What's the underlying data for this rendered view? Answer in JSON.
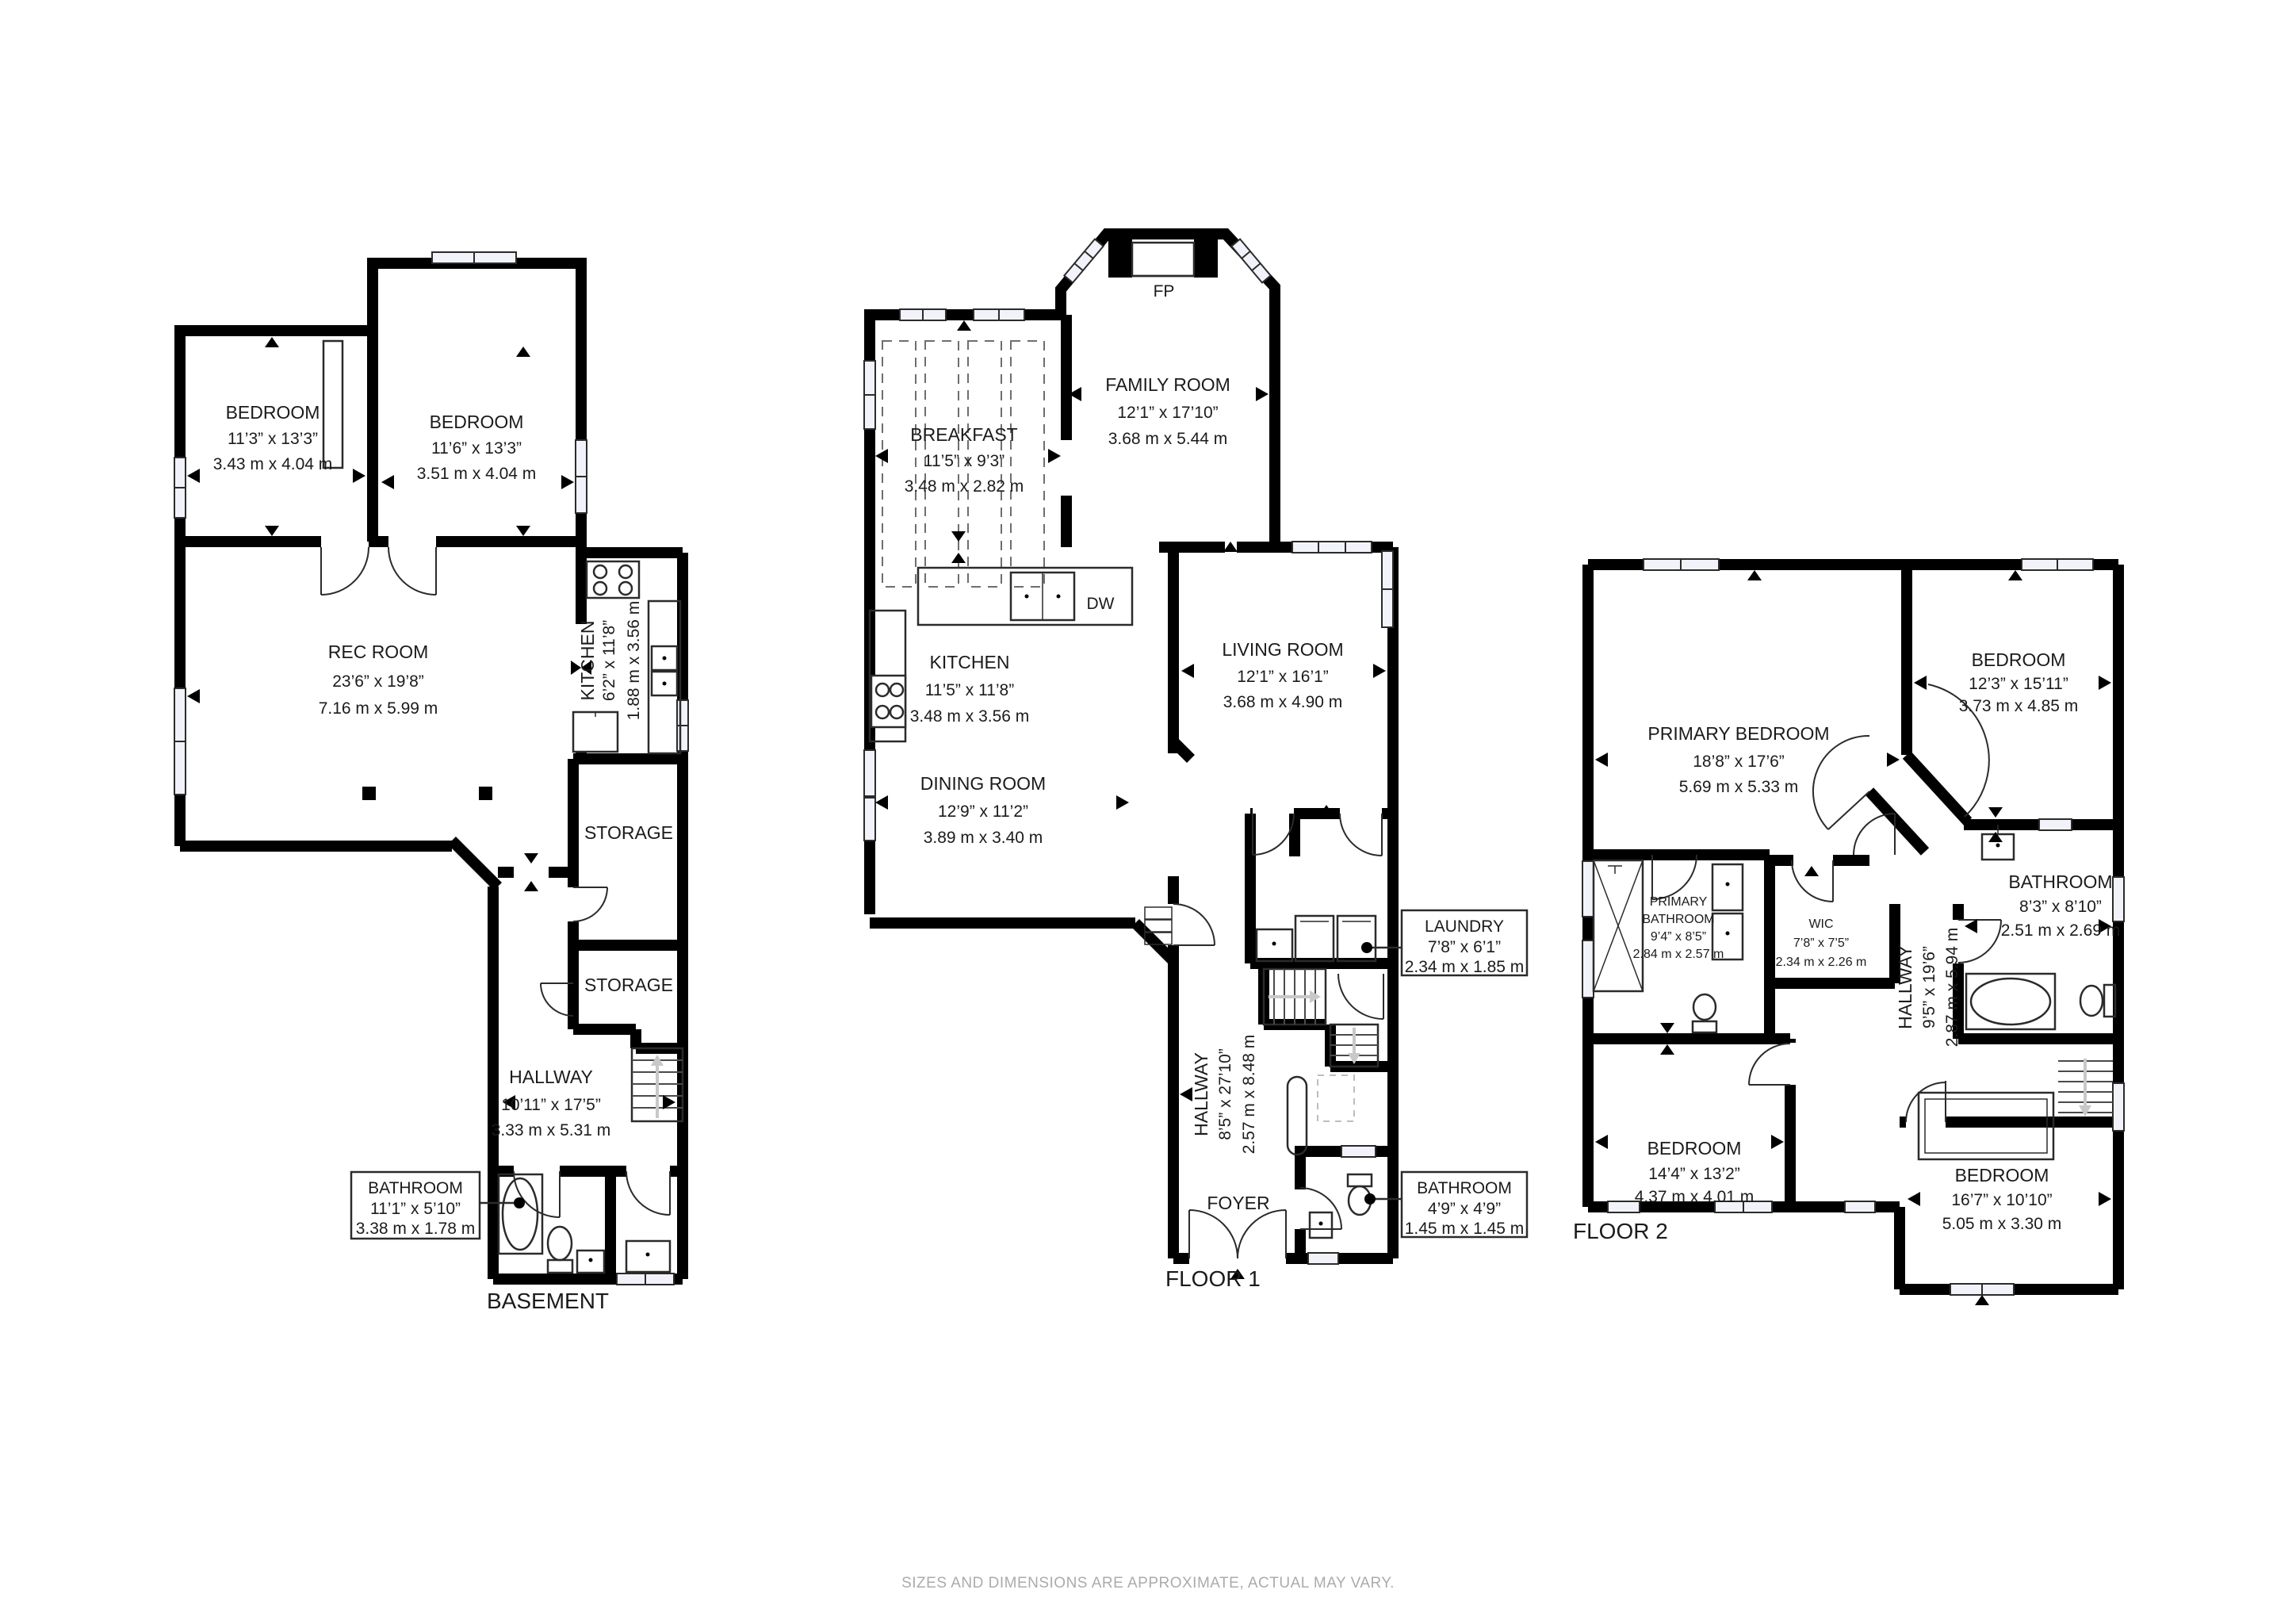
{
  "colors": {
    "wall": "#000000",
    "text": "#1b1b1b",
    "window_fill": "#f2f3fa",
    "muted_footer": "#ababab",
    "stair_arrow": "#c8c8c8"
  },
  "footer": {
    "disclaimer": "SIZES AND DIMENSIONS ARE APPROXIMATE, ACTUAL MAY VARY."
  },
  "plans": [
    {
      "title": "BASEMENT",
      "rooms": [
        {
          "id": "bedroom-left",
          "lines": [
            "BEDROOM",
            "11’3” x 13’3”",
            "3.43 m x 4.04 m"
          ]
        },
        {
          "id": "bedroom-right",
          "lines": [
            "BEDROOM",
            "11’6” x 13’3”",
            "3.51 m x 4.04 m"
          ]
        },
        {
          "id": "rec-room",
          "lines": [
            "REC ROOM",
            "23’6” x 19’8”",
            "7.16 m x 5.99 m"
          ]
        },
        {
          "id": "kitchen",
          "lines": [
            "KITCHEN",
            "6’2” x 11’8”",
            "1.88 m x 3.56 m"
          ]
        },
        {
          "id": "storage-upper",
          "lines": [
            "STORAGE"
          ]
        },
        {
          "id": "storage-lower",
          "lines": [
            "STORAGE"
          ]
        },
        {
          "id": "hallway",
          "lines": [
            "HALLWAY",
            "10’11” x 17’5”",
            "3.33 m x 5.31 m"
          ]
        },
        {
          "id": "bathroom",
          "lines": [
            "BATHROOM",
            "11’1” x 5’10”",
            "3.38 m x 1.78 m"
          ]
        }
      ]
    },
    {
      "title": "FLOOR 1",
      "fixtures": {
        "fireplace": "FP",
        "dishwasher": "DW"
      },
      "rooms": [
        {
          "id": "breakfast",
          "lines": [
            "BREAKFAST",
            "11’5” x 9’3”",
            "3.48 m x 2.82 m"
          ]
        },
        {
          "id": "family-room",
          "lines": [
            "FAMILY ROOM",
            "12’1” x 17’10”",
            "3.68 m x 5.44 m"
          ]
        },
        {
          "id": "kitchen",
          "lines": [
            "KITCHEN",
            "11’5” x 11’8”",
            "3.48 m x 3.56 m"
          ]
        },
        {
          "id": "living-room",
          "lines": [
            "LIVING ROOM",
            "12’1” x 16’1”",
            "3.68 m x 4.90 m"
          ]
        },
        {
          "id": "dining-room",
          "lines": [
            "DINING ROOM",
            "12’9” x 11’2”",
            "3.89 m x 3.40 m"
          ]
        },
        {
          "id": "hallway",
          "lines": [
            "HALLWAY",
            "8’5” x 27’10”",
            "2.57 m x 8.48 m"
          ]
        },
        {
          "id": "foyer",
          "lines": [
            "FOYER"
          ]
        },
        {
          "id": "laundry",
          "lines": [
            "LAUNDRY",
            "7’8” x 6’1”",
            "2.34 m x 1.85 m"
          ]
        },
        {
          "id": "bathroom",
          "lines": [
            "BATHROOM",
            "4’9” x 4’9”",
            "1.45 m x 1.45 m"
          ]
        }
      ]
    },
    {
      "title": "FLOOR 2",
      "rooms": [
        {
          "id": "primary-bedroom",
          "lines": [
            "PRIMARY BEDROOM",
            "18’8” x 17’6”",
            "5.69 m x 5.33 m"
          ]
        },
        {
          "id": "bedroom-top-right",
          "lines": [
            "BEDROOM",
            "12’3” x 15’11”",
            "3.73 m x 4.85 m"
          ]
        },
        {
          "id": "primary-bathroom",
          "lines": [
            "PRIMARY",
            "BATHROOM",
            "9’4” x 8’5”",
            "2.84 m x 2.57 m"
          ]
        },
        {
          "id": "wic",
          "lines": [
            "WIC",
            "7’8” x 7’5”",
            "2.34 m x 2.26 m"
          ]
        },
        {
          "id": "hallway",
          "lines": [
            "HALLWAY",
            "9’5” x 19’6”",
            "2.87 m x 5.94 m"
          ]
        },
        {
          "id": "bathroom",
          "lines": [
            "BATHROOM",
            "8’3” x 8’10”",
            "2.51 m x 2.69 m"
          ]
        },
        {
          "id": "bedroom-left",
          "lines": [
            "BEDROOM",
            "14’4” x 13’2”",
            "4.37 m x 4.01 m"
          ]
        },
        {
          "id": "bedroom-bottom",
          "lines": [
            "BEDROOM",
            "16’7” x 10’10”",
            "5.05 m x 3.30 m"
          ]
        }
      ]
    }
  ]
}
